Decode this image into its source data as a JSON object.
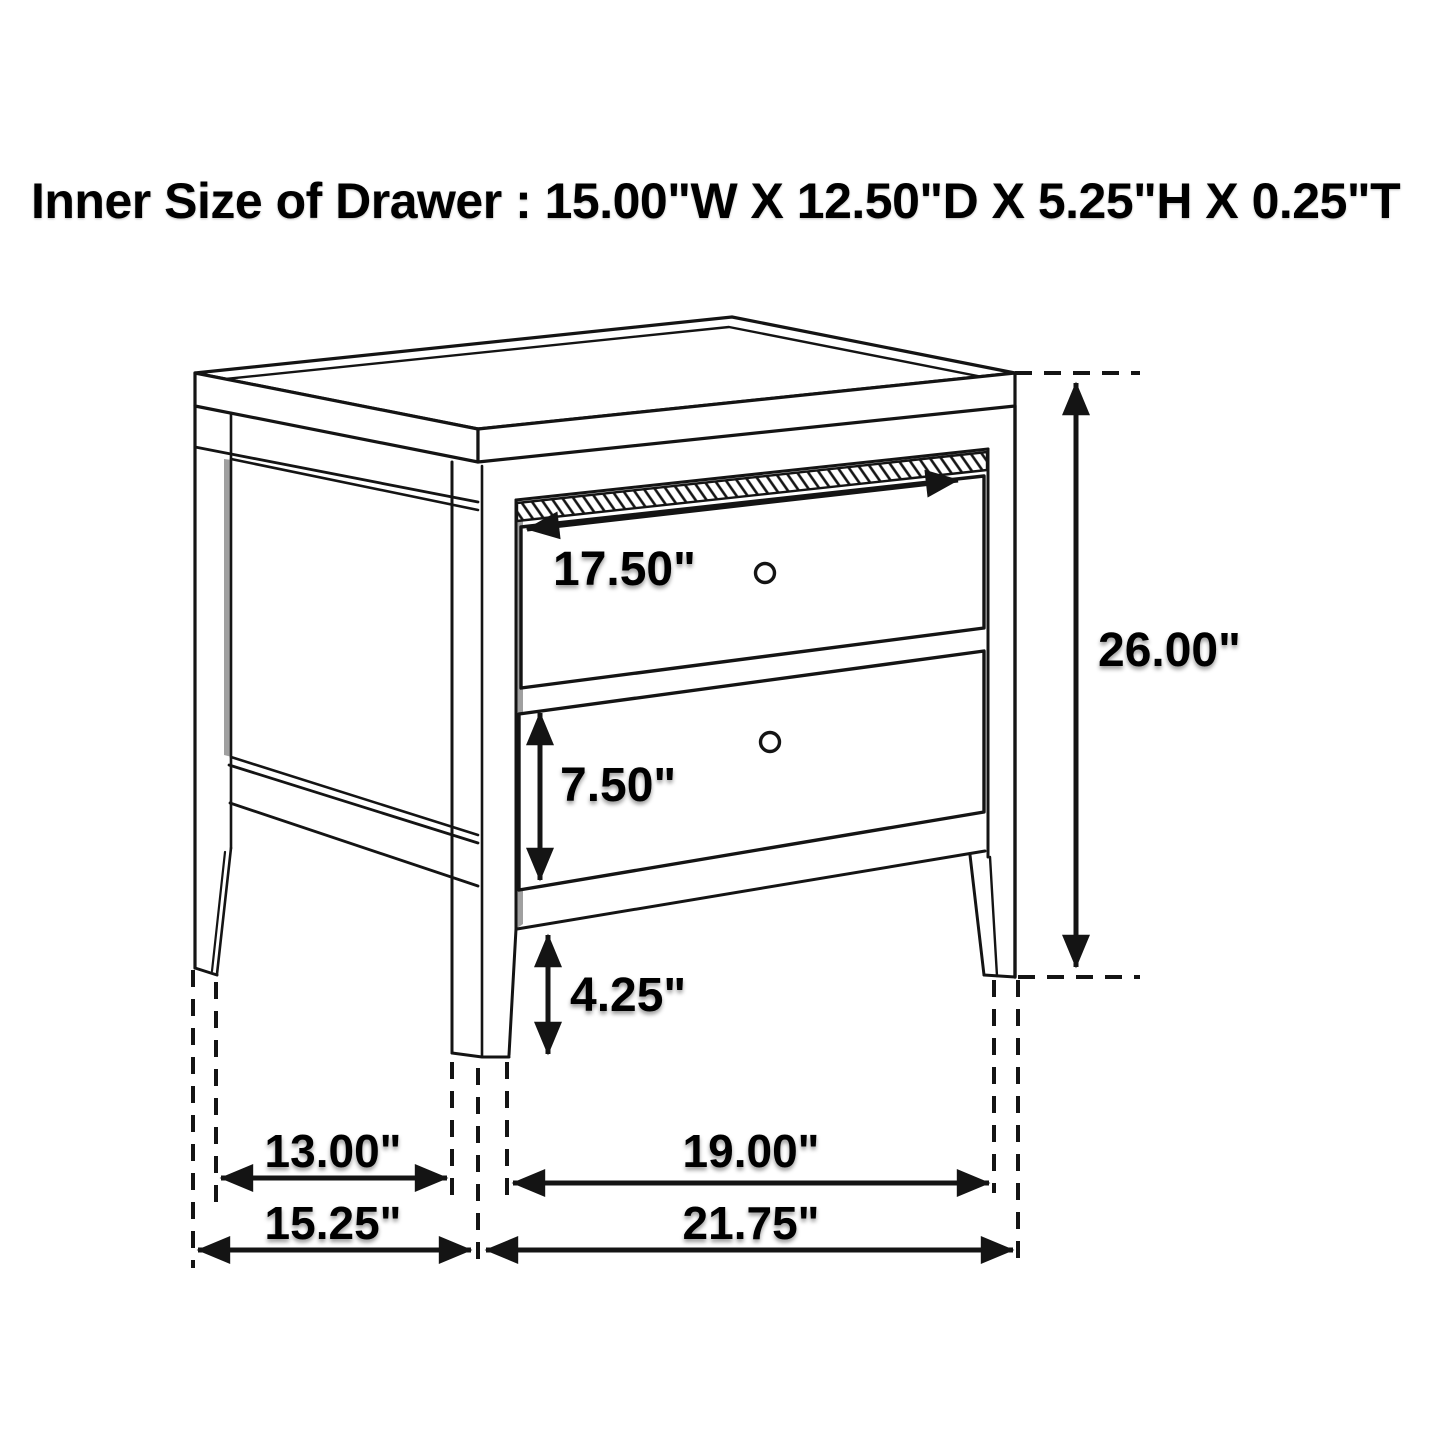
{
  "title": {
    "text": "Inner Size of Drawer : 15.00\"W X 12.50\"D X 5.25\"H X 0.25\"T"
  },
  "diagram": {
    "type": "furniture-dimension-diagram",
    "item": "two-drawer nightstand, 3/4 perspective line drawing",
    "colors": {
      "background": "#ffffff",
      "line": "#141414",
      "shadow_band": "#a0a0a0",
      "text": "#000000"
    },
    "dimensions": [
      {
        "label": "17.50\"",
        "measures": "top drawer front width",
        "orientation": "diagonal-horizontal"
      },
      {
        "label": "26.00\"",
        "measures": "overall height",
        "orientation": "vertical"
      },
      {
        "label": "7.50\"",
        "measures": "bottom drawer front height",
        "orientation": "vertical"
      },
      {
        "label": "4.25\"",
        "measures": "leg height floor clearance",
        "orientation": "vertical"
      },
      {
        "label": "13.00\"",
        "measures": "side leg span inner",
        "orientation": "horizontal"
      },
      {
        "label": "19.00\"",
        "measures": "front leg span inner",
        "orientation": "horizontal"
      },
      {
        "label": "15.25\"",
        "measures": "overall side depth",
        "orientation": "horizontal"
      },
      {
        "label": "21.75\"",
        "measures": "overall front width",
        "orientation": "horizontal"
      }
    ],
    "drawer_knob_count": 2
  }
}
